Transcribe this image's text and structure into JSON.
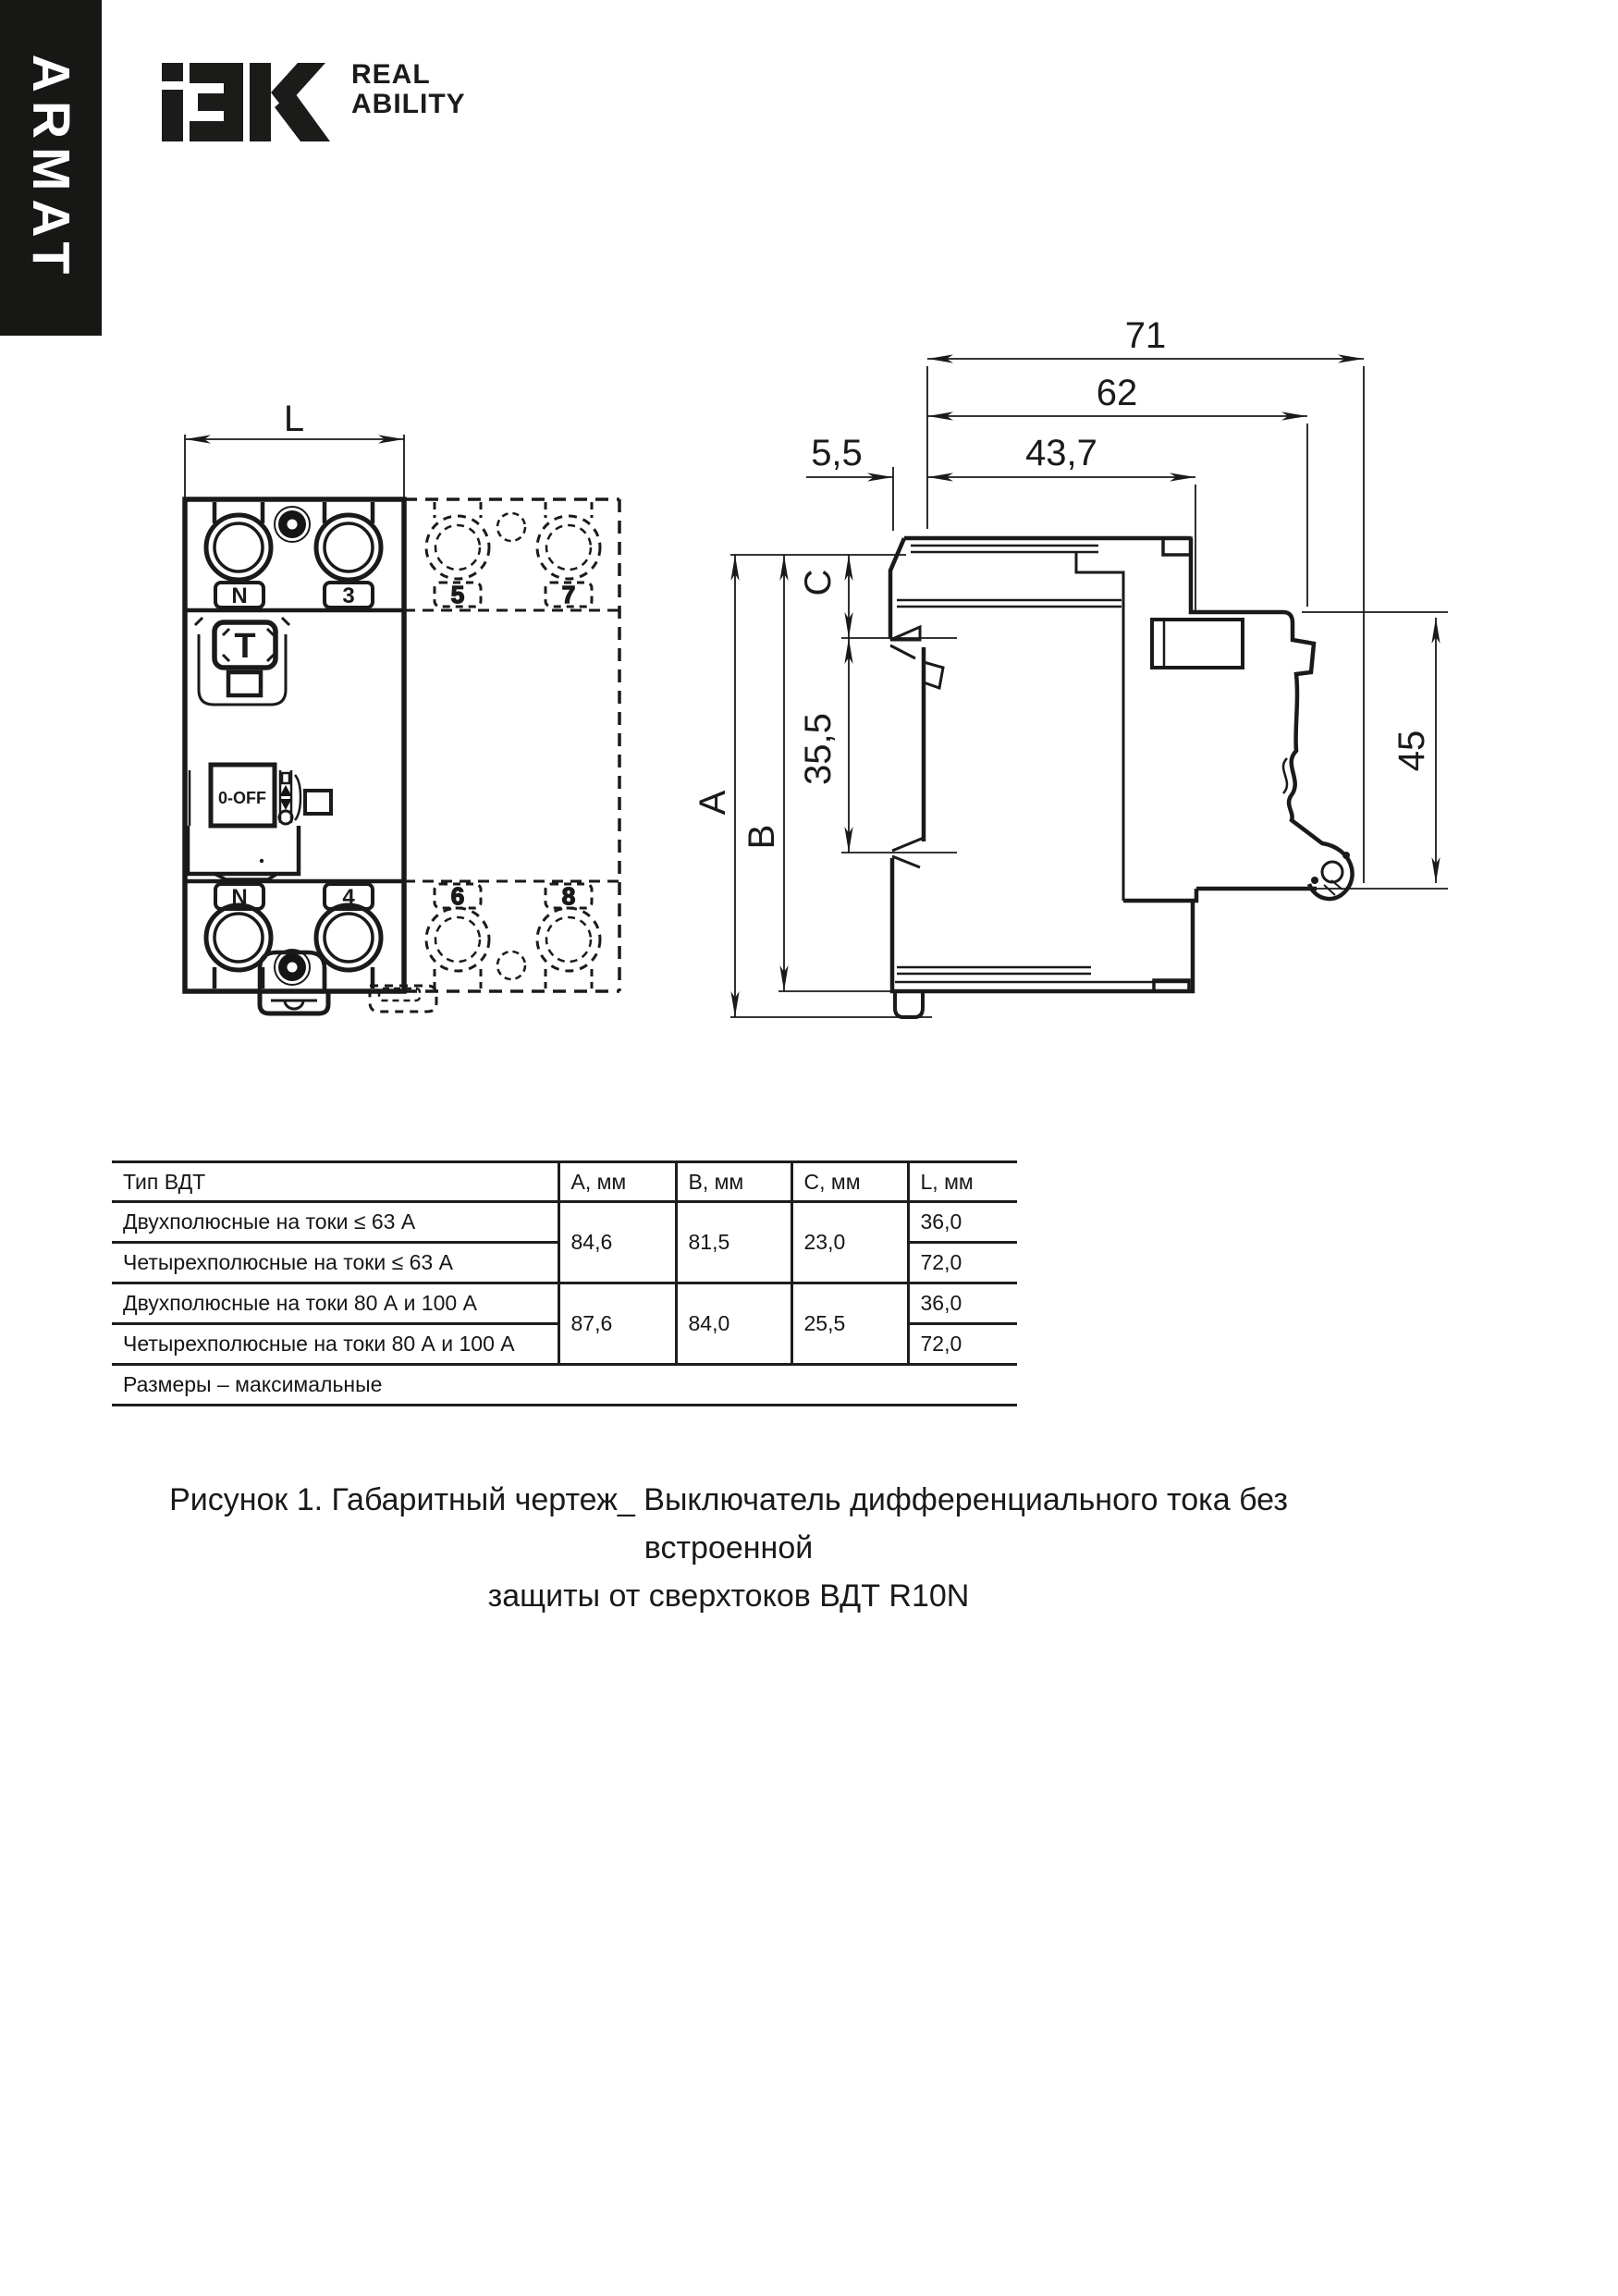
{
  "banner": {
    "series": "ARMAT"
  },
  "logo": {
    "tagline_line1": "REAL",
    "tagline_line2": "ABILITY"
  },
  "front_view": {
    "width_dim": "L",
    "test_button": "T",
    "switch_label": "0-OFF",
    "terminal_top_left": "N",
    "terminal_top_right": "3",
    "terminal_top_d1": "5",
    "terminal_top_d2": "7",
    "terminal_bottom_left": "N",
    "terminal_bottom_right": "4",
    "terminal_bottom_d1": "6",
    "terminal_bottom_d2": "8"
  },
  "side_view": {
    "depth_total": "71",
    "depth_body": "62",
    "panel_offset": "5,5",
    "depth_front": "43,7",
    "height_a": "A",
    "height_b": "B",
    "height_c": "C",
    "rail_window": "35,5",
    "rail_height": "45"
  },
  "table": {
    "headers": {
      "type": "Тип ВДТ",
      "a": "A, мм",
      "b": "B, мм",
      "c": "C, мм",
      "l": "L, мм"
    },
    "rows": [
      {
        "type": "Двухполюсные на токи ≤ 63 А",
        "a": "84,6",
        "b": "81,5",
        "c": "23,0",
        "l": "36,0"
      },
      {
        "type": "Четырехполюсные на токи ≤ 63 А",
        "l": "72,0"
      },
      {
        "type": "Двухполюсные на токи 80 А и 100 А",
        "a": "87,6",
        "b": "84,0",
        "c": "25,5",
        "l": "36,0"
      },
      {
        "type": "Четырехполюсные на токи 80 А и 100 А",
        "l": "72,0"
      }
    ],
    "note": "Размеры – максимальные"
  },
  "caption": {
    "line1": "Рисунок 1. Габаритный чертеж_ Выключатель дифференциального тока без встроенной",
    "line2": "защиты от сверхтоков ВДТ R10N"
  }
}
